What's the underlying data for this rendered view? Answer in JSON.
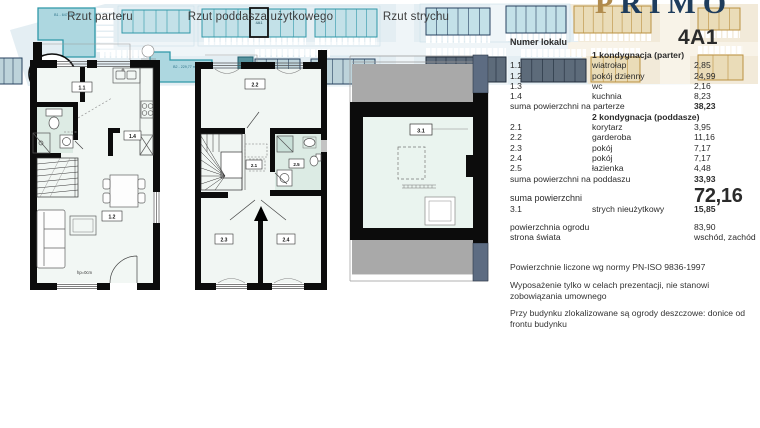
{
  "logo": {
    "gold_letter": "P",
    "rest_letters": "RIMO"
  },
  "plan_titles": {
    "parter": "Rzut parteru",
    "poddasze": "Rzut poddasza użytkowego",
    "strych": "Rzut strychu"
  },
  "plan_labels": {
    "p1": {
      "r11": "1.1",
      "r12": "1.2",
      "r14": "1.4",
      "hp": "hp=0cm"
    },
    "p2": {
      "r21": "2.1",
      "r22": "2.2",
      "r23": "2.3",
      "r24": "2.4",
      "r25": "2.5"
    },
    "p3": {
      "r31": "3.1"
    }
  },
  "info": {
    "header_label": "Numer lokalu",
    "unit": "4A1",
    "section1": {
      "title": "1 kondygnacja (parter)",
      "rows": [
        {
          "id": "1.1",
          "name": "wiatrołap",
          "area": "2,85"
        },
        {
          "id": "1.2",
          "name": "pokój dzienny",
          "area": "24,99"
        },
        {
          "id": "1.3",
          "name": "wc",
          "area": "2,16"
        },
        {
          "id": "1.4",
          "name": "kuchnia",
          "area": "8,23"
        }
      ],
      "sum_label": "suma powierzchni na parterze",
      "sum_value": "38,23"
    },
    "section2": {
      "title": "2 kondygnacja (poddasze)",
      "rows": [
        {
          "id": "2.1",
          "name": "korytarz",
          "area": "3,95"
        },
        {
          "id": "2.2",
          "name": "garderoba",
          "area": "11,16"
        },
        {
          "id": "2.3",
          "name": "pokój",
          "area": "7,17"
        },
        {
          "id": "2.4",
          "name": "pokój",
          "area": "7,17"
        },
        {
          "id": "2.5",
          "name": "łazienka",
          "area": "4,48"
        }
      ],
      "sum_label": "suma powierzchni na poddaszu",
      "sum_value": "33,93"
    },
    "total_label": "suma powierzchni",
    "total_value": "72,16",
    "attic": {
      "id": "3.1",
      "name": "strych nieużytkowy",
      "area": "15,85"
    },
    "garden_label": "powierzchnia ogrodu",
    "garden_value": "83,90",
    "orientation_label": "strona świata",
    "orientation_value": "wschód, zachód"
  },
  "notes": [
    "Powierzchnie liczone wg normy PN-ISO 9836-1997",
    "Wyposażenie tylko w celach prezentacji, nie stanowi zobowiązania umownego",
    "Przy budynku zlokalizowane są ogrody deszczowe: donice od frontu budynku"
  ],
  "site": {
    "building1_label": "B1 - 647,78 m²",
    "building2_label": "B2 - 229,77 m²",
    "highlighted_unit": "4A1"
  },
  "colors": {
    "logo_gold": "#b08b4e",
    "logo_navy": "#1e3c5c",
    "plan_teal": "#2f98a8",
    "site_beige_stroke": "#bb9141",
    "site_navy": "#27415f"
  }
}
